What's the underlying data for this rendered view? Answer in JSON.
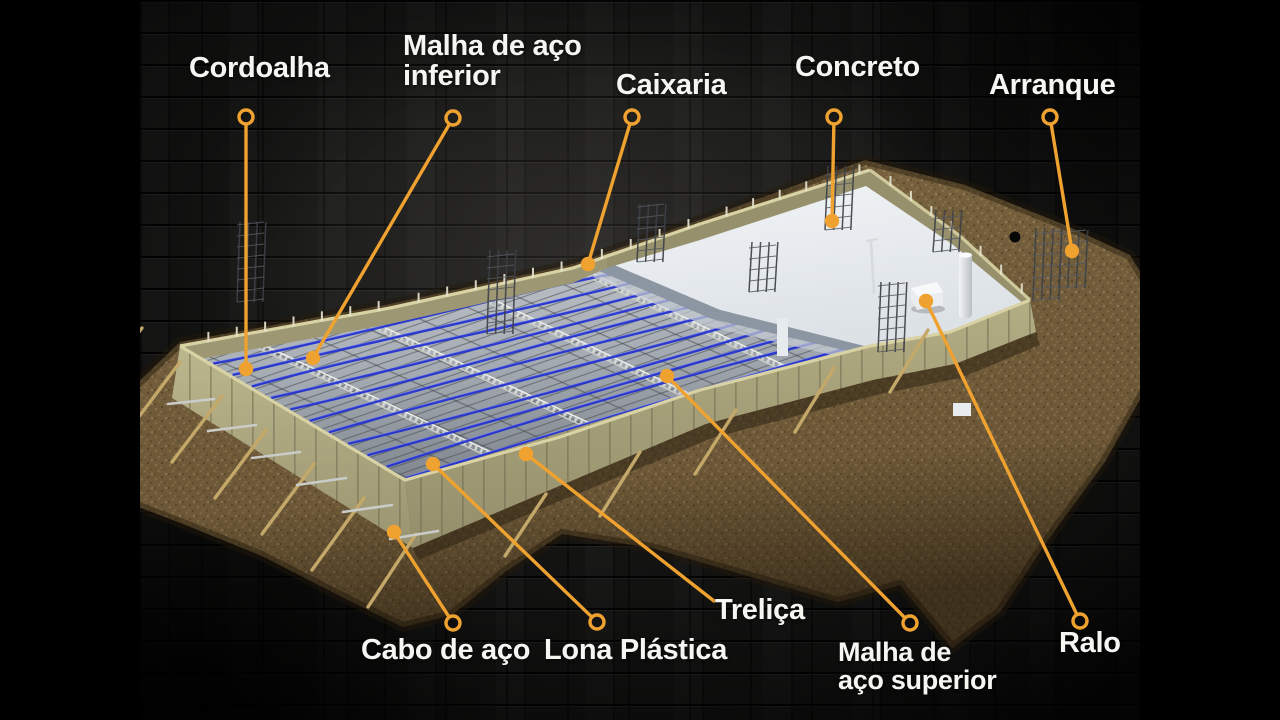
{
  "scene": {
    "width": 1280,
    "height": 720,
    "background": "#000000"
  },
  "frame": {
    "letterbox_left_width": 140,
    "letterbox_right_start": 1140
  },
  "colors": {
    "accent_orange": "#efa230",
    "label_text": "#f5f5f2",
    "cable_blue": "#2433cf",
    "cable_highlight": "#8e98f0",
    "formwork_tan": "#b2ac83",
    "soil_brown": "#7a6440",
    "concrete_white": "#e9edf0",
    "sheet_grey": "#aab0b7",
    "brick_dark": "#151514"
  },
  "diagram": {
    "labels": [
      {
        "id": "cordoalha",
        "text": "Cordoalha",
        "x": 189,
        "y": 53,
        "size": 29
      },
      {
        "id": "malha-inferior",
        "text": "Malha de aço\ninferior",
        "x": 403,
        "y": 31,
        "size": 29
      },
      {
        "id": "caixaria",
        "text": "Caixaria",
        "x": 616,
        "y": 70,
        "size": 29
      },
      {
        "id": "concreto",
        "text": "Concreto",
        "x": 795,
        "y": 52,
        "size": 29
      },
      {
        "id": "arranque",
        "text": "Arranque",
        "x": 989,
        "y": 70,
        "size": 29
      },
      {
        "id": "cabo-de-aco",
        "text": "Cabo de aço",
        "x": 361,
        "y": 635,
        "size": 29
      },
      {
        "id": "lona-plastica",
        "text": "Lona Plástica",
        "x": 544,
        "y": 635,
        "size": 29
      },
      {
        "id": "trelica",
        "text": "Treliça",
        "x": 715,
        "y": 595,
        "size": 29
      },
      {
        "id": "malha-superior",
        "text": "Malha de\naço superior",
        "x": 838,
        "y": 638,
        "size": 27
      },
      {
        "id": "ralo",
        "text": "Ralo",
        "x": 1059,
        "y": 628,
        "size": 29
      }
    ],
    "leaders": [
      {
        "id": "cordoalha",
        "ring": [
          246,
          117
        ],
        "target": [
          246,
          369
        ]
      },
      {
        "id": "malha-inferior",
        "ring": [
          453,
          118
        ],
        "target": [
          313,
          358
        ]
      },
      {
        "id": "caixaria",
        "ring": [
          632,
          117
        ],
        "target": [
          588,
          264
        ]
      },
      {
        "id": "concreto",
        "ring": [
          834,
          117
        ],
        "target": [
          832,
          221
        ]
      },
      {
        "id": "arranque",
        "ring": [
          1050,
          117
        ],
        "target": [
          1072,
          251
        ]
      },
      {
        "id": "cabo-de-aco",
        "ring": [
          453,
          623
        ],
        "target": [
          394,
          532
        ]
      },
      {
        "id": "lona-plastica",
        "ring": [
          597,
          622
        ],
        "target": [
          433,
          464
        ]
      },
      {
        "id": "trelica",
        "ring": null,
        "start": [
          714,
          601
        ],
        "target": [
          526,
          454
        ]
      },
      {
        "id": "malha-superior",
        "ring": [
          910,
          623
        ],
        "target": [
          667,
          376
        ]
      },
      {
        "id": "ralo",
        "ring": [
          1080,
          621
        ],
        "target": [
          926,
          301
        ]
      }
    ],
    "cables": {
      "count": 12
    }
  }
}
